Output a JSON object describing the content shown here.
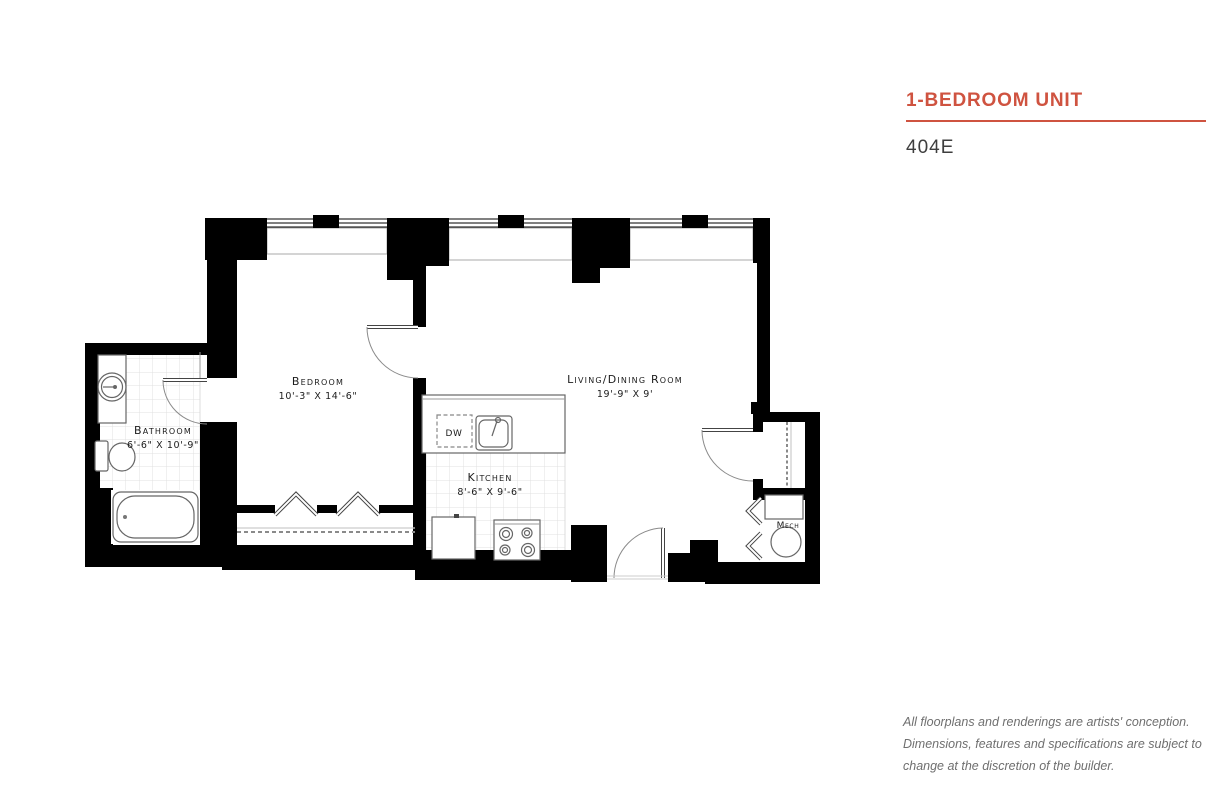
{
  "header": {
    "title": "1-BEDROOM UNIT",
    "unit_number": "404E",
    "accent_color": "#cf5340",
    "unit_text_color": "#3e3e3e"
  },
  "floorplan": {
    "wall_color": "#000000",
    "rooms": [
      {
        "id": "bathroom",
        "label": "Bathroom",
        "dimensions": "6'-6\" X 10'-9\""
      },
      {
        "id": "bedroom",
        "label": "Bedroom",
        "dimensions": "10'-3\" X 14'-6\""
      },
      {
        "id": "kitchen",
        "label": "Kitchen",
        "dimensions": "8'-6\" X 9'-6\""
      },
      {
        "id": "living_dining",
        "label": "Living/Dining Room",
        "dimensions": "19'-9\" X 9'"
      },
      {
        "id": "mech",
        "label": "Mech",
        "dimensions": ""
      }
    ],
    "appliances": {
      "dishwasher_label": "DW"
    }
  },
  "disclaimer": {
    "text_color": "#6f6f6f",
    "lines": [
      "All floorplans and renderings are artists' conception.",
      "Dimensions, features and specifications are subject to",
      "change at the discretion of the builder."
    ]
  }
}
